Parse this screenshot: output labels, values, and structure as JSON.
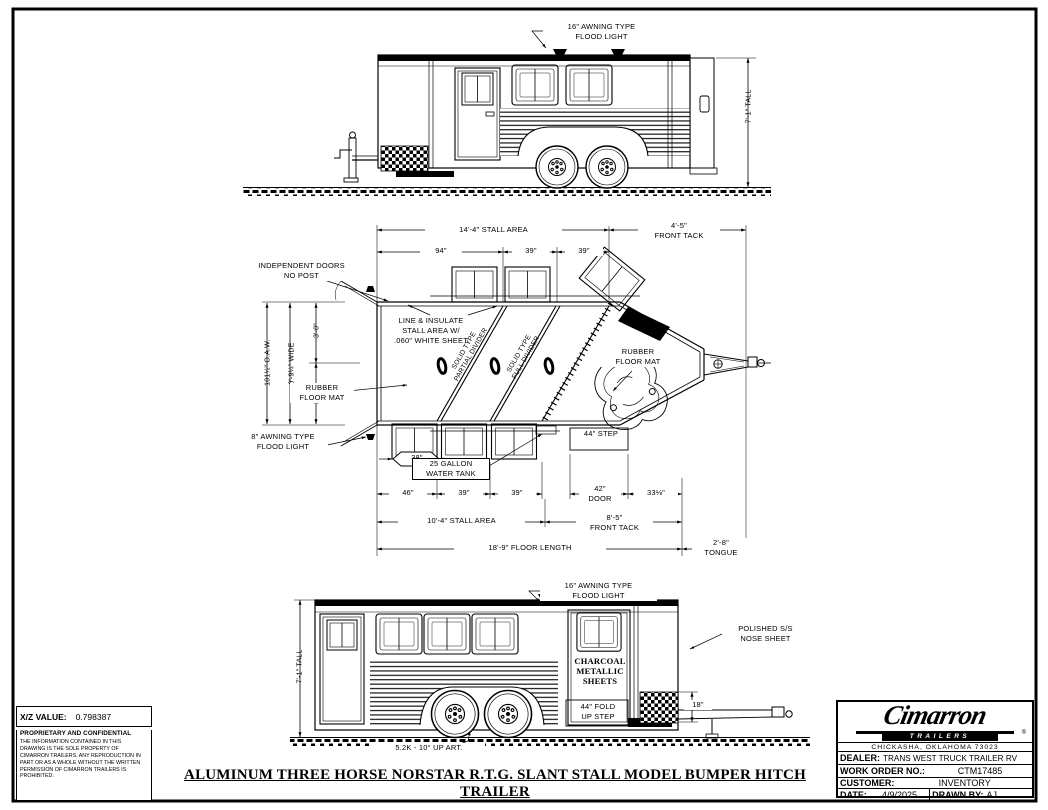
{
  "colors": {
    "ink": "#000000",
    "paper": "#ffffff"
  },
  "drawing_title": "ALUMINUM THREE HORSE NORSTAR R.T.G. SLANT STALL MODEL BUMPER HITCH TRAILER",
  "info_panel": {
    "xz_label": "X/Z VALUE:",
    "xz_value": "0.798387",
    "confidential_title": "PROPRIETARY AND CONFIDENTIAL",
    "confidential_body": "THE INFORMATION CONTAINED IN THIS DRAWING IS THE SOLE PROPERTY OF CIMARRON TRAILERS. ANY REPRODUCTION IN PART OR AS A WHOLE WITHOUT THE WRITTEN PERMISSION OF CIMARRON TRAILERS IS PROHIBITED."
  },
  "title_block": {
    "logo_main": "Cimarron",
    "logo_sub": "TRAILERS",
    "logo_reg": "®",
    "address": "CHICKASHA, OKLAHOMA 73023",
    "dealer_label": "DEALER:",
    "dealer_value": "TRANS WEST TRUCK TRAILER RV",
    "work_order_label": "WORK ORDER NO.:",
    "work_order_value": "CTM17485",
    "customer_label": "CUSTOMER:",
    "customer_value": "INVENTORY",
    "date_label": "DATE:",
    "date_value": "4/9/2025",
    "drawn_by_label": "DRAWN BY:",
    "drawn_by_value": "AJ"
  },
  "side_view_top": {
    "flood_light": "16\" AWNING TYPE\nFLOOD LIGHT",
    "height_dim": "7'-1\" TALL"
  },
  "plan_view": {
    "independent_doors": "INDEPENDENT DOORS\nNO POST",
    "stall_area_top": "14'-4\" STALL AREA",
    "front_tack_top": "4'-5\"\nFRONT TACK",
    "dim_94": "94\"",
    "dim_39_a": "39\"",
    "dim_39_b": "39\"",
    "line_insulate": "LINE & INSULATE\nSTALL AREA W/\n.060\" WHITE SHEET",
    "dim_oaw": "101½\" O.A.W.",
    "dim_wide": "6'-9¼\" WIDE",
    "dim_3_0": "3'-0\"",
    "dim_3_9": "3'-9¼\"",
    "divider_partial": "SOLID TYPE\nPARTIAL DIVIDER",
    "divider_full": "SOLID TYPE\nFULL DIVIDER",
    "rubber_mat_right": "RUBBER\nFLOOR MAT",
    "rubber_mat_left": "RUBBER\nFLOOR MAT",
    "flood_light_8": "8\" AWNING TYPE\nFLOOD LIGHT",
    "dim_38": "38\"",
    "water_tank": "25 GALLON\nWATER TANK",
    "step_44": "44\" STEP",
    "dim_46": "46\"",
    "dim_39_c": "39\"",
    "dim_39_d": "39\"",
    "door_42": "42\"\nDOOR",
    "dim_33": "33⅛\"",
    "stall_area_bottom": "10'-4\" STALL AREA",
    "front_tack_bottom": "8'-5\"\nFRONT TACK",
    "floor_length": "18'-9\" FLOOR LENGTH",
    "tongue": "2'-8\"\nTONGUE"
  },
  "side_view_bottom": {
    "flood_light": "16\" AWNING TYPE\nFLOOD LIGHT",
    "polished_nose": "POLISHED S/S\nNOSE SHEET",
    "height_dim": "7'-1\" TALL",
    "charcoal": "CHARCOAL\nMETALLIC\nSHEETS",
    "fold_step": "44\" FOLD\nUP STEP",
    "dim_18": "18\"",
    "axle": "5.2K - 10° UP ART."
  }
}
